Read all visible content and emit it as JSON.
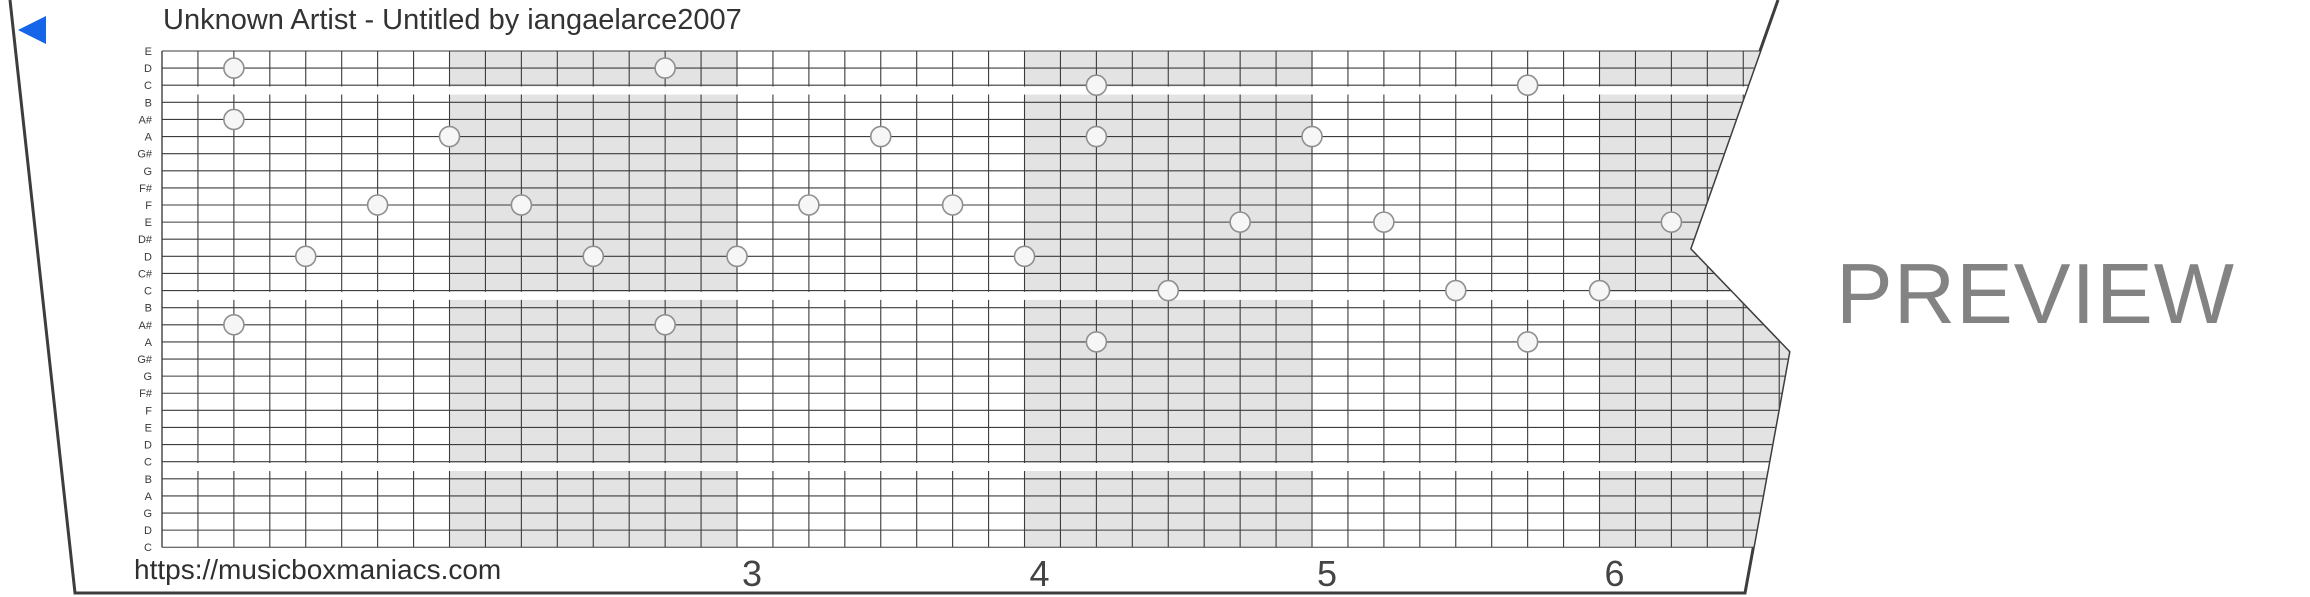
{
  "strip": {
    "title": "Unknown Artist - Untitled by iangaelarce2007",
    "url": "https://musicboxmaniacs.com",
    "watermark": "PREVIEW",
    "row_labels": [
      "E",
      "D",
      "C",
      "B",
      "A#",
      "A",
      "G#",
      "G",
      "F#",
      "F",
      "E",
      "D#",
      "D",
      "C#",
      "C",
      "B",
      "A#",
      "A",
      "G#",
      "G",
      "F#",
      "F",
      "E",
      "D",
      "C",
      "B",
      "A",
      "G",
      "D",
      "C"
    ],
    "measure_numbers": [
      "3",
      "4",
      "5",
      "6"
    ],
    "first_labeled_measure": 3,
    "shaded_measures": [
      2,
      4,
      6
    ],
    "octave_gap_rows": [
      2,
      14,
      24
    ],
    "notes": [
      {
        "row": 1,
        "col": 2,
        "pitch": "D"
      },
      {
        "row": 1,
        "col": 14,
        "pitch": "D"
      },
      {
        "row": 2,
        "col": 26,
        "pitch": "C"
      },
      {
        "row": 2,
        "col": 38,
        "pitch": "C"
      },
      {
        "row": 4,
        "col": 2,
        "pitch": "A#"
      },
      {
        "row": 5,
        "col": 8,
        "pitch": "A"
      },
      {
        "row": 5,
        "col": 20,
        "pitch": "A"
      },
      {
        "row": 5,
        "col": 26,
        "pitch": "A"
      },
      {
        "row": 5,
        "col": 32,
        "pitch": "A"
      },
      {
        "row": 9,
        "col": 6,
        "pitch": "F"
      },
      {
        "row": 9,
        "col": 10,
        "pitch": "F"
      },
      {
        "row": 9,
        "col": 18,
        "pitch": "F"
      },
      {
        "row": 9,
        "col": 22,
        "pitch": "F"
      },
      {
        "row": 10,
        "col": 30,
        "pitch": "E"
      },
      {
        "row": 10,
        "col": 34,
        "pitch": "E"
      },
      {
        "row": 10,
        "col": 42,
        "pitch": "E"
      },
      {
        "row": 12,
        "col": 4,
        "pitch": "D"
      },
      {
        "row": 12,
        "col": 12,
        "pitch": "D"
      },
      {
        "row": 12,
        "col": 16,
        "pitch": "D"
      },
      {
        "row": 12,
        "col": 24,
        "pitch": "D"
      },
      {
        "row": 14,
        "col": 28,
        "pitch": "C"
      },
      {
        "row": 14,
        "col": 36,
        "pitch": "C"
      },
      {
        "row": 14,
        "col": 40,
        "pitch": "C"
      },
      {
        "row": 16,
        "col": 2,
        "pitch": "A#"
      },
      {
        "row": 16,
        "col": 14,
        "pitch": "A#"
      },
      {
        "row": 17,
        "col": 26,
        "pitch": "A"
      },
      {
        "row": 17,
        "col": 38,
        "pitch": "A"
      }
    ],
    "colors": {
      "play_button": "#1565e8",
      "grid_line": "#3c3c3c",
      "shaded_measure": "#e3e3e3",
      "octave_gap": "#ffffff",
      "note_fill": "#f6f6f6",
      "note_stroke": "#8f8f8f",
      "strip_edge": "#3d3d3d",
      "label_text": "#3a3a3a",
      "number_text": "#444444",
      "watermark_text": "#838383"
    }
  }
}
